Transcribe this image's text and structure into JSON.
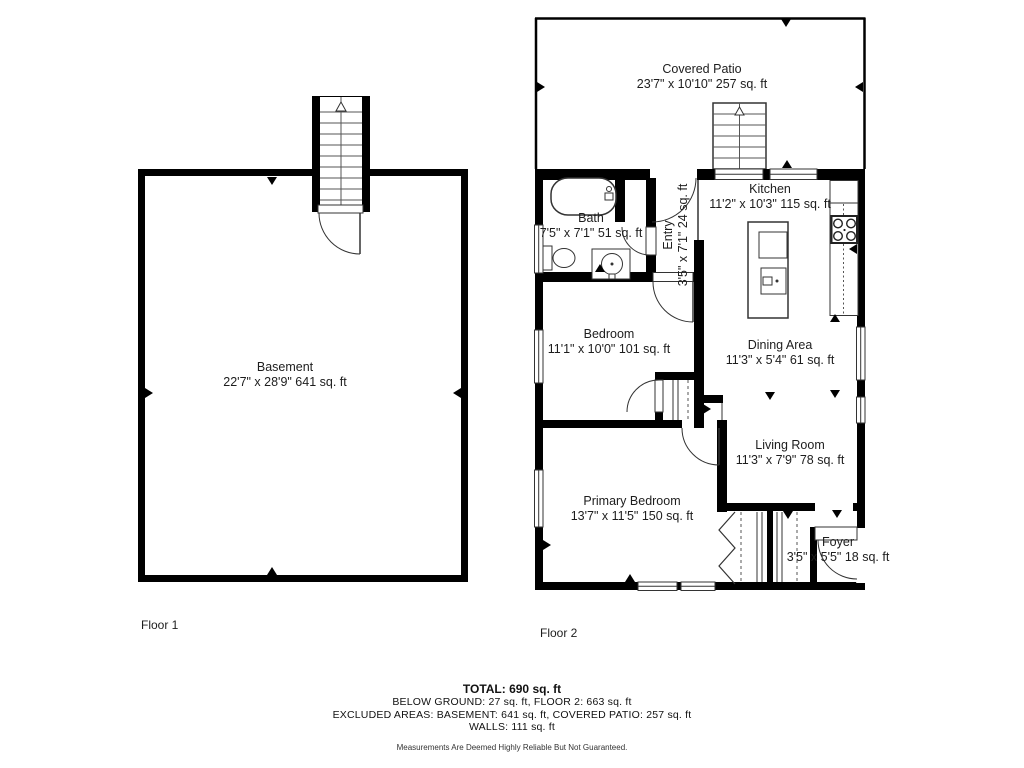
{
  "floor1": {
    "label": "Floor 1",
    "basement": {
      "name": "Basement",
      "dims": "22'7\" x 28'9\" 641 sq. ft"
    }
  },
  "floor2": {
    "label": "Floor 2",
    "covered_patio": {
      "name": "Covered Patio",
      "dims": "23'7\" x 10'10\" 257 sq. ft"
    },
    "kitchen": {
      "name": "Kitchen",
      "dims": "11'2\" x 10'3\" 115 sq. ft"
    },
    "bath": {
      "name": "Bath",
      "dims": "7'5\" x 7'1\" 51 sq. ft"
    },
    "entry": {
      "name": "Entry",
      "dims": "3'5\" x 7'1\" 24 sq. ft"
    },
    "bedroom": {
      "name": "Bedroom",
      "dims": "11'1\" x 10'0\" 101 sq. ft"
    },
    "dining_area": {
      "name": "Dining Area",
      "dims": "11'3\" x 5'4\" 61 sq. ft"
    },
    "living_room": {
      "name": "Living Room",
      "dims": "11'3\" x 7'9\" 78 sq. ft"
    },
    "primary_bedroom": {
      "name": "Primary Bedroom",
      "dims": "13'7\" x 11'5\" 150 sq. ft"
    },
    "foyer": {
      "name": "Foyer",
      "dims": "3'5\" x 5'5\" 18 sq. ft"
    }
  },
  "summary": {
    "total": "TOTAL: 690 sq. ft",
    "below_ground": "BELOW GROUND: 27 sq. ft, FLOOR 2: 663 sq. ft",
    "excluded": "EXCLUDED AREAS: BASEMENT: 641 sq. ft, COVERED PATIO: 257 sq. ft",
    "walls": "WALLS: 111 sq. ft",
    "disclaimer": "Measurements Are Deemed Highly Reliable But Not Guaranteed."
  },
  "colors": {
    "wall": "#000000",
    "background": "#ffffff",
    "text": "#1d1d1d"
  }
}
